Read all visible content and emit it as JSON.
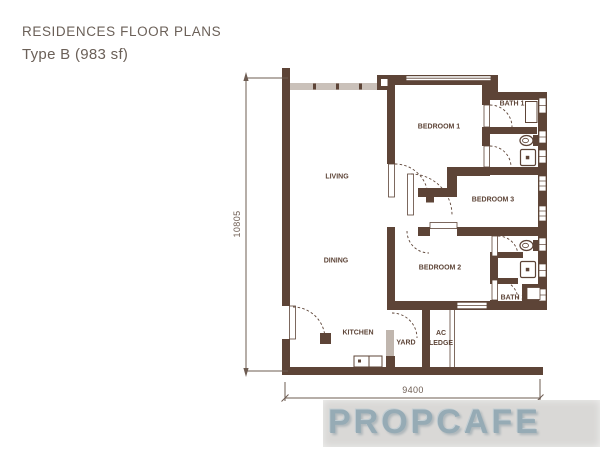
{
  "header": {
    "title": "RESIDENCES FLOOR PLANS",
    "subtitle": "Type B (983 sf)"
  },
  "floor_plan": {
    "rooms": [
      {
        "id": "living",
        "label": "LIVING"
      },
      {
        "id": "dining",
        "label": "DINING"
      },
      {
        "id": "kitchen",
        "label": "KITCHEN"
      },
      {
        "id": "yard",
        "label": "YARD"
      },
      {
        "id": "ac-ledge",
        "label": "AC LEDGE"
      },
      {
        "id": "bedroom1",
        "label": "BEDROOM 1"
      },
      {
        "id": "bedroom2",
        "label": "BEDROOM 2"
      },
      {
        "id": "bedroom3",
        "label": "BEDROOM 3"
      },
      {
        "id": "bath1",
        "label": "BATH 1"
      },
      {
        "id": "bath2",
        "label": "BATH 2"
      }
    ],
    "dimensions": {
      "height_mm": "10805",
      "width_mm": "9400"
    }
  },
  "watermark": {
    "text": "PROPCAFE"
  },
  "colors": {
    "wall": "#5d4437",
    "window_band": "#cac1ba",
    "louver_gray": "#c0b6ae",
    "title_text": "#6b6058",
    "dimension_line": "#6d5c52",
    "watermark_bg": "#d9d8d6",
    "watermark_text": "#96abb5"
  }
}
